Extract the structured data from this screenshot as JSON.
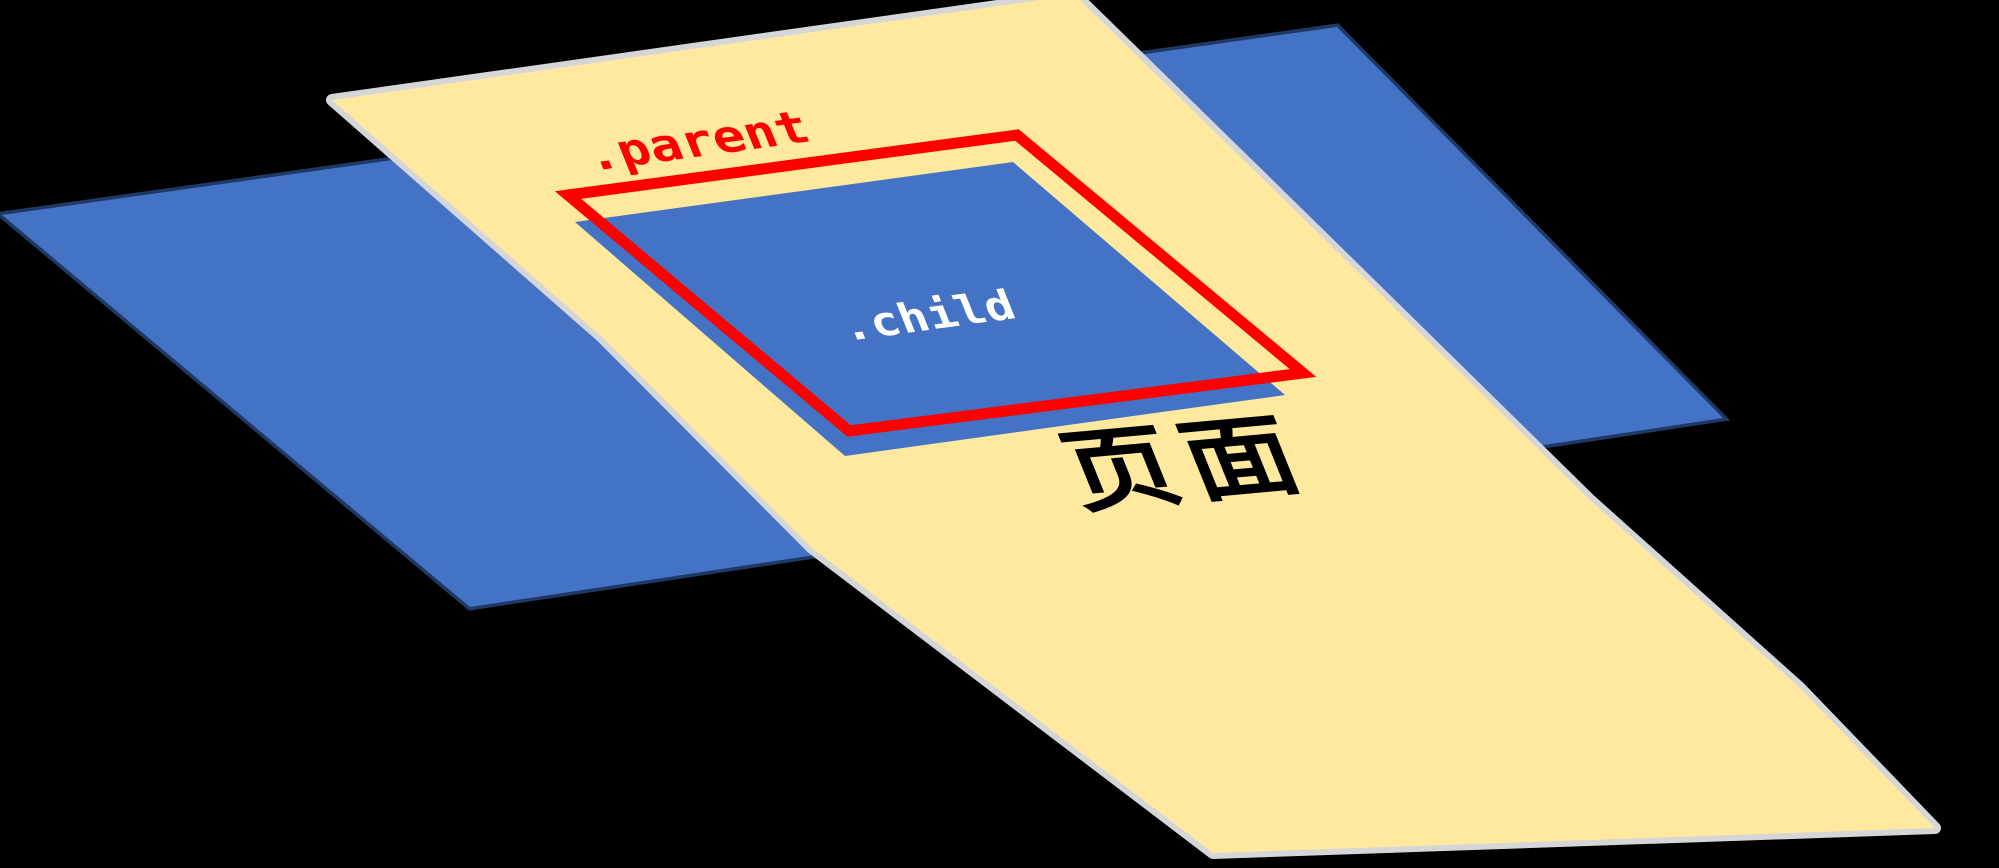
{
  "diagram": {
    "title": "css-position-containing-block-illustration",
    "labels": {
      "parent": ".parent",
      "child": ".child",
      "page": "页面"
    },
    "colors": {
      "background": "#000000",
      "page_fill": "#ffe99e",
      "page_edge": "#d6d6d9",
      "back_plane_fill": "#4472c4",
      "back_plane_border": "#1f3864",
      "child_fill": "#4472c4",
      "parent_outline": "#ff0000",
      "parent_label": "#ff0000",
      "child_label": "#ffffff",
      "page_label": "#000000"
    }
  }
}
